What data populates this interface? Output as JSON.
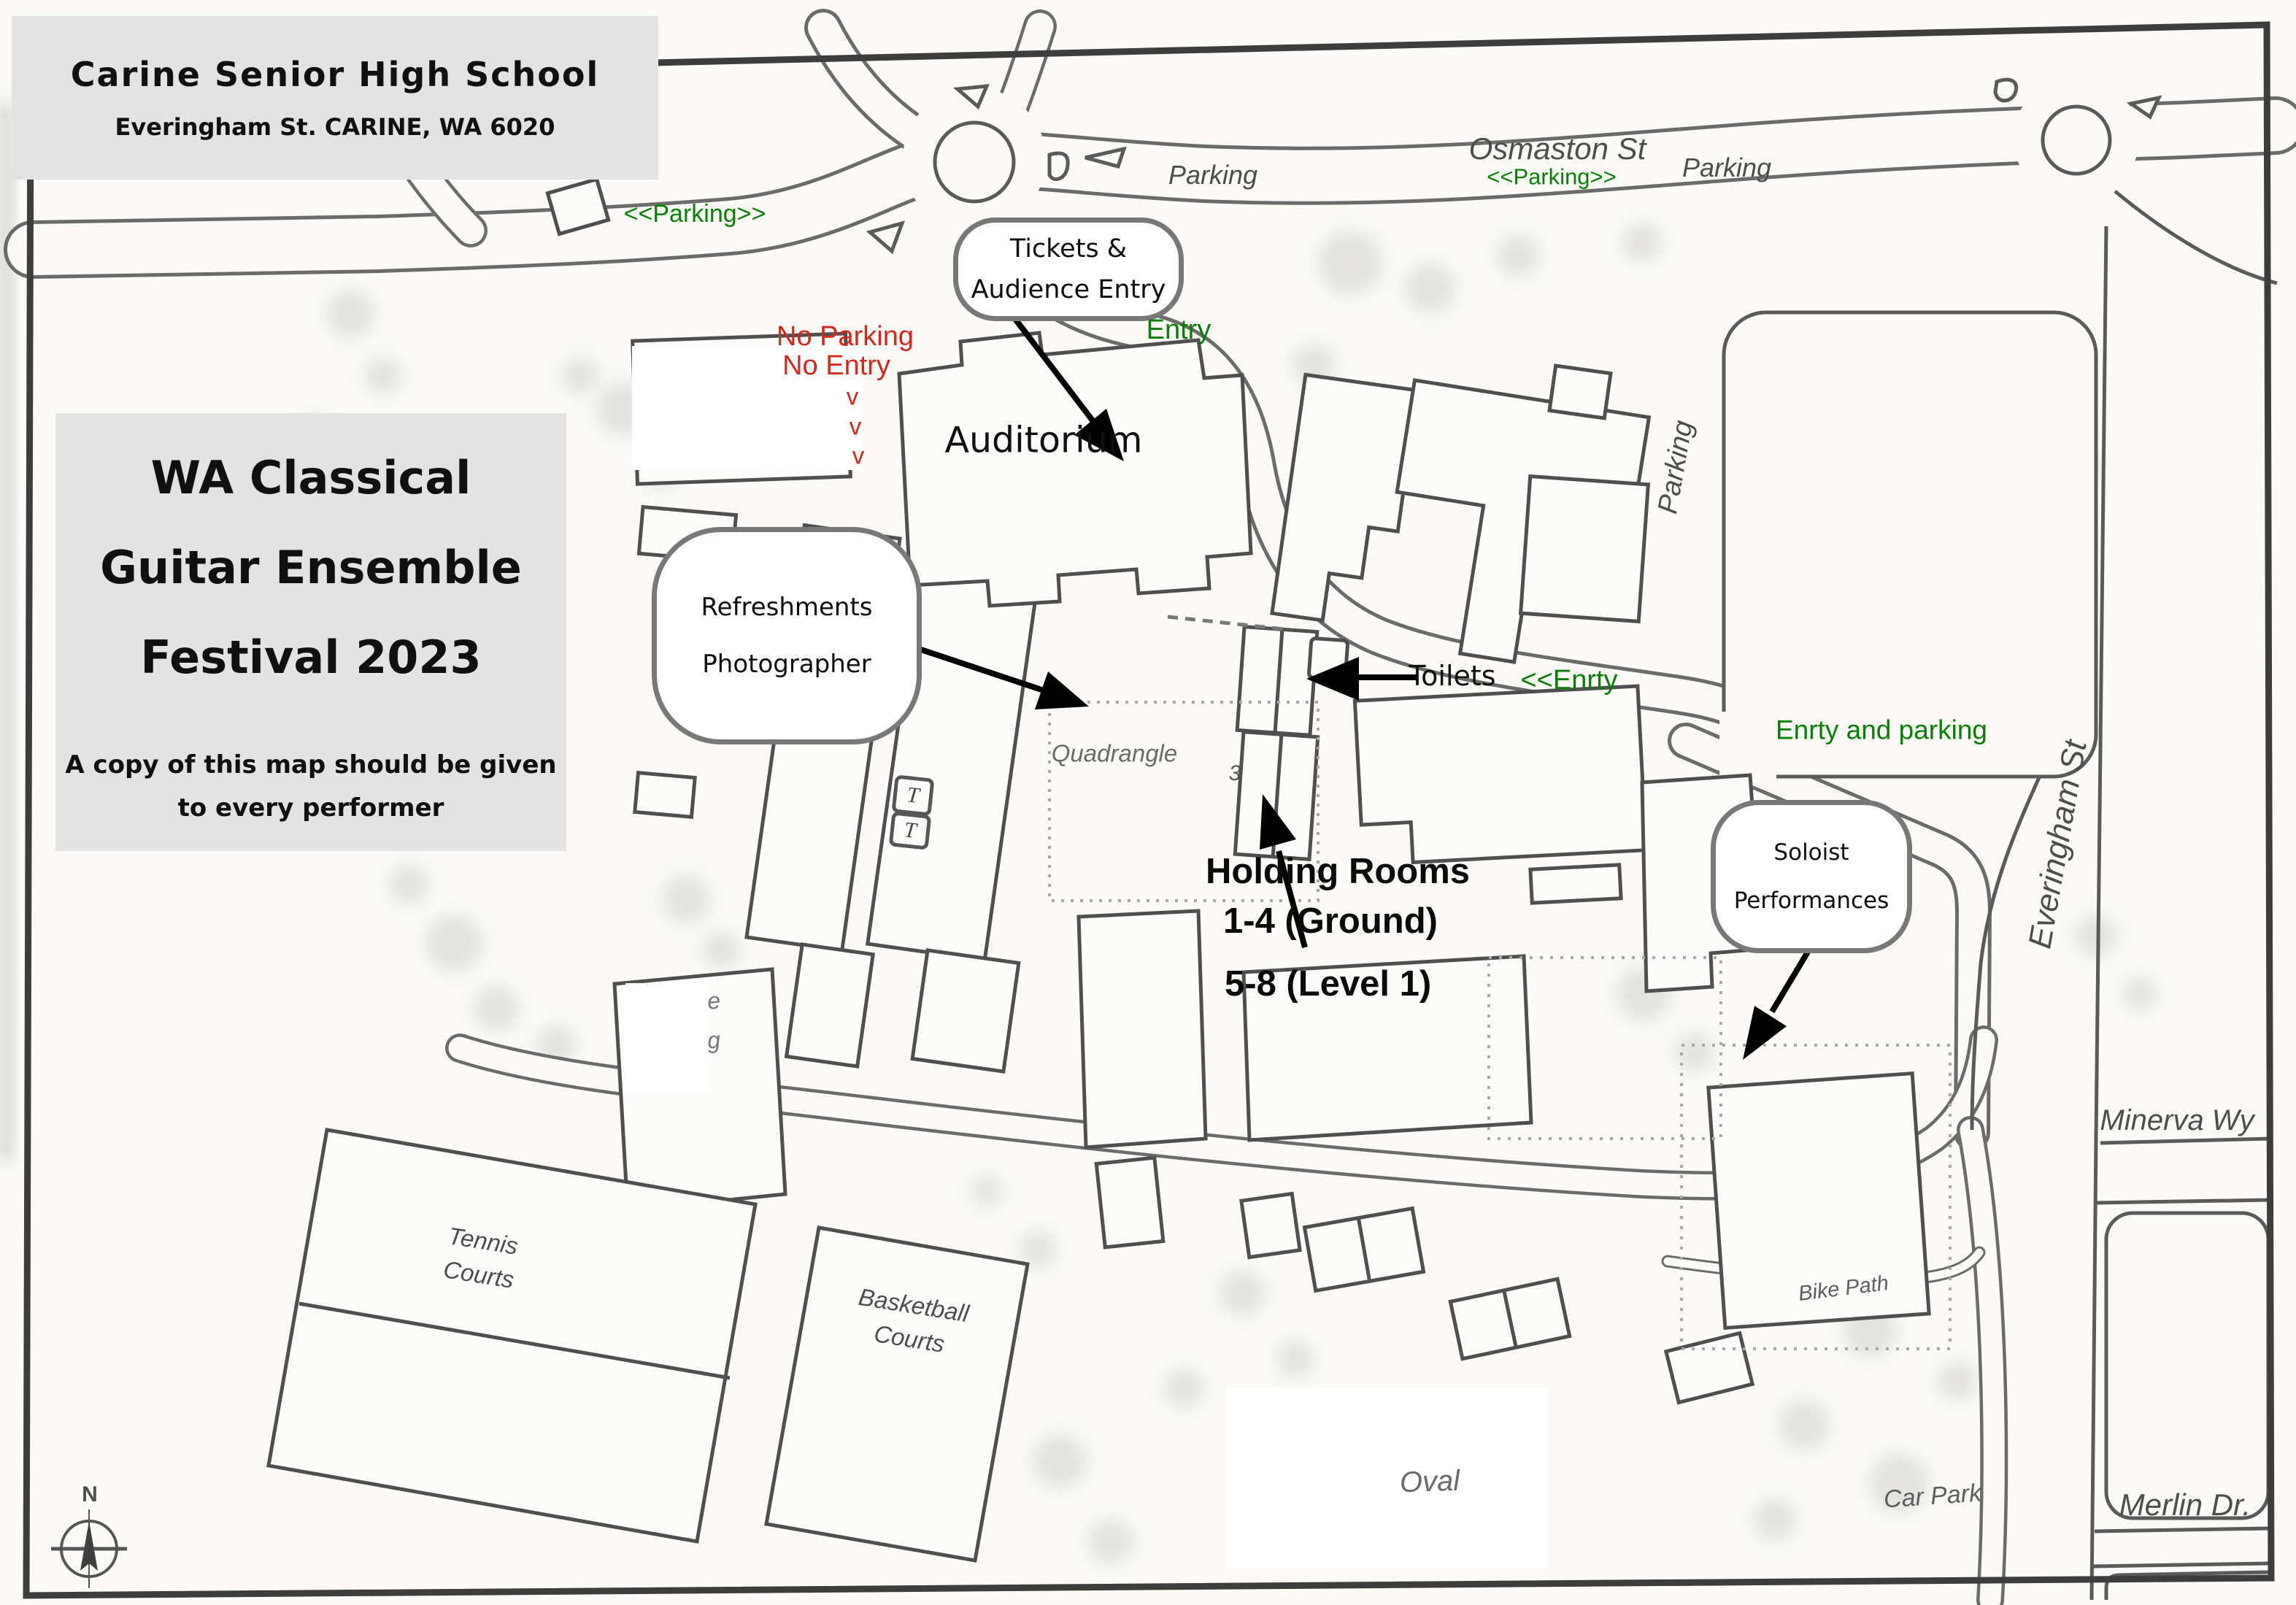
{
  "title_block": {
    "school_name": "Carine Senior High School",
    "school_address": "Everingham St. CARINE, WA 6020"
  },
  "info_panel": {
    "event_line1": "WA Classical",
    "event_line2": "Guitar Ensemble",
    "event_line3": "Festival 2023",
    "note_line1": "A copy of this map should be given",
    "note_line2": "to every performer"
  },
  "callouts": {
    "tickets_line1": "Tickets &",
    "tickets_line2": "Audience Entry",
    "refresh_line1": "Refreshments",
    "refresh_line2": "Photographer",
    "soloist_line1": "Soloist",
    "soloist_line2": "Performances"
  },
  "annotations": {
    "auditorium": "Auditorium",
    "toilets": "Toilets",
    "holding_line1": "Holding Rooms",
    "holding_line2": "1-4 (Ground)",
    "holding_line3": "5-8 (Level 1)",
    "no_parking": "No Parking",
    "no_entry": "No Entry",
    "chevron": "v"
  },
  "green_labels": {
    "parking_left": "<<Parking>>",
    "parking_osmaston": "<<Parking>>",
    "entry": "Entry",
    "enrty": "<<Enrty",
    "enrty_and_parking": "Enrty and parking"
  },
  "map_labels": {
    "osmaston_st": "Osmaston St",
    "parking_ne": "Parking",
    "parking_mid": "Parking",
    "parking_vertical": "Parking",
    "everingham_st": "Everingham St",
    "quadrangle": "Quadrangle",
    "tennis_line1": "Tennis",
    "tennis_line2": "Courts",
    "basketball_line1": "Basketball",
    "basketball_line2": "Courts",
    "oval": "Oval",
    "bike_path": "Bike Path",
    "car_park": "Car Park",
    "minerva_wy": "Minerva Wy",
    "merlin_dr": "Merlin Dr.",
    "toilet_t1": "T",
    "toilet_t2": "T",
    "room_3": "3",
    "fragment_e": "e",
    "fragment_g": "g",
    "compass_n": "N"
  },
  "colors": {
    "annotation_green": "#0a7d0a",
    "annotation_red": "#d2281e",
    "map_ink": "#4d4d4d"
  }
}
